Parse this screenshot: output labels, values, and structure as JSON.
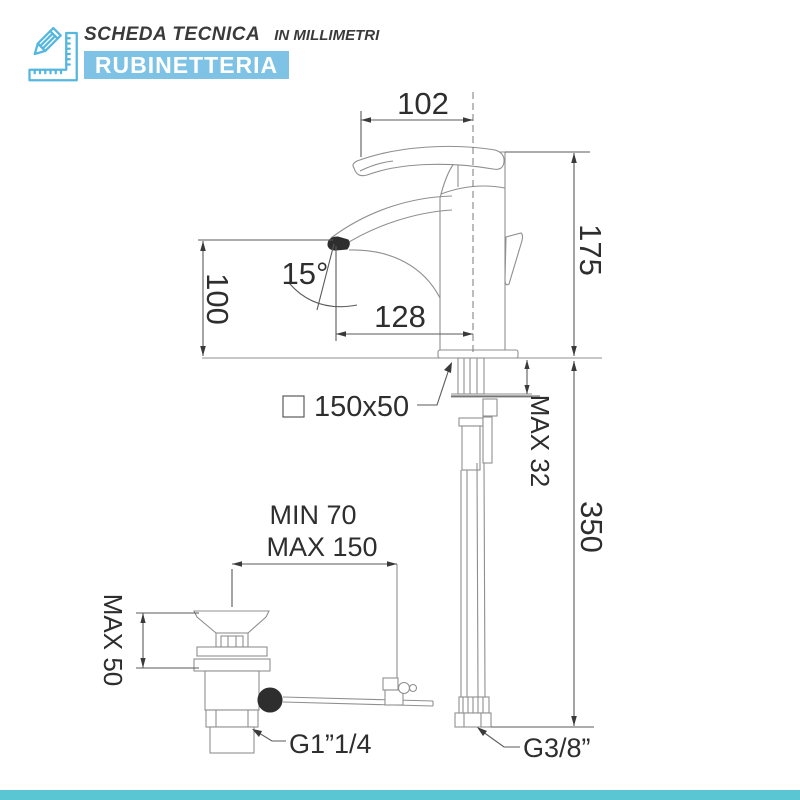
{
  "header": {
    "title": "SCHEDA TECNICA",
    "subtitle": "IN MILLIMETRI",
    "banner": "RUBINETTERIA"
  },
  "drawing": {
    "dim_spout_reach": "102",
    "dim_total_height": "175",
    "dim_spout_height": "100",
    "dim_spout_angle": "15°",
    "dim_tip_to_base": "128",
    "dim_mounting_hole": "150x50",
    "dim_counter_thickness": "MAX 32",
    "dim_supply_length": "350",
    "dim_rod_min": "MIN 70",
    "dim_rod_max": "MAX 150",
    "dim_drain_height": "MAX 50",
    "label_drain_thread": "G1”1/4",
    "label_supply_thread": "G3/8”"
  },
  "colors": {
    "banner_blue": "#7ec3e6",
    "icon_blue": "#55b7de",
    "footer_teal": "#5ac6d3",
    "drawing_line_gray": "#8f8f8f",
    "dimension_text": "#2e2e2e"
  }
}
